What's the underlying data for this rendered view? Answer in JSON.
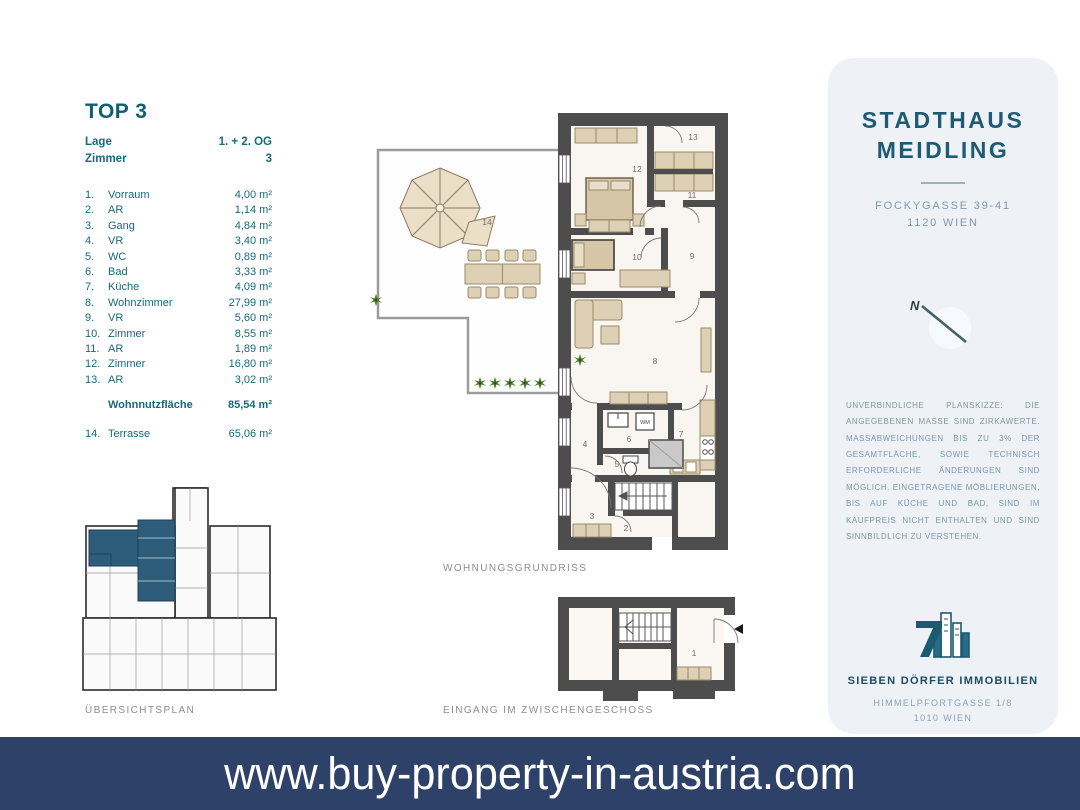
{
  "unit": {
    "title": "TOP 3",
    "meta": [
      {
        "label": "Lage",
        "value": "1. + 2. OG"
      },
      {
        "label": "Zimmer",
        "value": "3"
      }
    ],
    "rooms": [
      {
        "no": "1.",
        "name": "Vorraum",
        "area": "4,00 m²"
      },
      {
        "no": "2.",
        "name": "AR",
        "area": "1,14 m²"
      },
      {
        "no": "3.",
        "name": "Gang",
        "area": "4,84 m²"
      },
      {
        "no": "4.",
        "name": "VR",
        "area": "3,40 m²"
      },
      {
        "no": "5.",
        "name": "WC",
        "area": "0,89 m²"
      },
      {
        "no": "6.",
        "name": "Bad",
        "area": "3,33 m²"
      },
      {
        "no": "7.",
        "name": "Küche",
        "area": "4,09 m²"
      },
      {
        "no": "8.",
        "name": "Wohnzimmer",
        "area": "27,99 m²"
      },
      {
        "no": "9.",
        "name": "VR",
        "area": "5,60 m²"
      },
      {
        "no": "10.",
        "name": "Zimmer",
        "area": "8,55 m²"
      },
      {
        "no": "11.",
        "name": "AR",
        "area": "1,89 m²"
      },
      {
        "no": "12.",
        "name": "Zimmer",
        "area": "16,80 m²"
      },
      {
        "no": "13.",
        "name": "AR",
        "area": "3,02 m²"
      }
    ],
    "total": {
      "label": "Wohnnutzfläche",
      "value": "85,54 m²"
    },
    "terrace": {
      "no": "14.",
      "name": "Terrasse",
      "area": "65,06 m²"
    }
  },
  "plans": {
    "main_label": "WOHNUNGSGRUNDRISS",
    "entrance_label": "EINGANG IM ZWISCHENGESCHOSS",
    "overview_label": "ÜBERSICHTSPLAN",
    "north_letter": "N",
    "wm_label": "WM",
    "room_numbers": {
      "n1": "1",
      "n2": "2",
      "n3": "3",
      "n4": "4",
      "n5": "5",
      "n6": "6",
      "n7": "7",
      "n8": "8",
      "n9": "9",
      "n10": "10",
      "n11": "11",
      "n12": "12",
      "n13": "13",
      "n14": "14"
    }
  },
  "panel": {
    "title_line1": "STADTHAUS",
    "title_line2": "MEIDLING",
    "address_line1": "FOCKYGASSE 39-41",
    "address_line2": "1120 WIEN",
    "disclaimer": "UNVERBINDLICHE PLANSKIZZE: DIE ANGEGEBENEN MASSE SIND ZIRKAWERTE. MASSABWEICHUNGEN BIS ZU 3% DER GESAMTFLÄCHE, SOWIE TECHNISCH ERFORDERLICHE ÄNDERUNGEN SIND MÖGLICH. EINGETRAGENE MÖBLIERUNGEN, BIS AUF KÜCHE UND BAD, SIND IM KAUFPREIS NICHT ENTHALTEN UND SIND SINNBILDLICH ZU VERSTEHEN.",
    "company": "SIEBEN DÖRFER IMMOBILIEN",
    "company_address1": "HIMMELPFORTGASSE 1/8",
    "company_address2": "1010 WIEN",
    "email": "OFFICE@7DOERFER.AT",
    "phone": "+43 1 9392929"
  },
  "banner": {
    "url_text": "www.buy-property-in-austria.com"
  },
  "colors": {
    "teal_text": "#17697c",
    "panel_bg": "#eef2f7",
    "banner_navy": "#2e4168",
    "wall_gray": "#4d4d4d",
    "floor": "#f9f5f1",
    "furniture": "#ddd0b5",
    "highlight_blue": "#2e5d7c",
    "plant_green": "#4e7d2e"
  }
}
